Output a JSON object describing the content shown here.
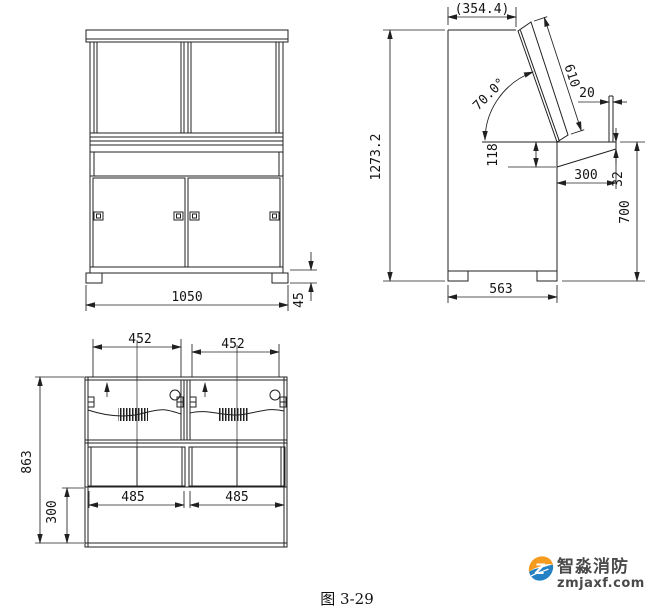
{
  "caption": "图 3-29",
  "front_view": {
    "dims": {
      "width": "1050",
      "base_height": "45"
    }
  },
  "side_view": {
    "dims": {
      "top_depth": "(354.4)",
      "panel_length": "610",
      "panel_angle": "70.0°",
      "rear_lip": "20",
      "apron": "118",
      "desk_depth": "300",
      "desk_edge": "32",
      "desk_height": "700",
      "total_height": "1273.2",
      "base_depth": "563"
    }
  },
  "plan_view": {
    "dims": {
      "door_left": "452",
      "door_right": "452",
      "overall_depth": "863",
      "front_depth": "300",
      "bay_left": "485",
      "bay_right": "485"
    }
  },
  "watermark": {
    "brand": "智淼消防",
    "domain": "zmjaxf.com",
    "colors": {
      "orange": "#F59B1E",
      "blue": "#2381C4",
      "text": "#4A4A4B"
    }
  }
}
